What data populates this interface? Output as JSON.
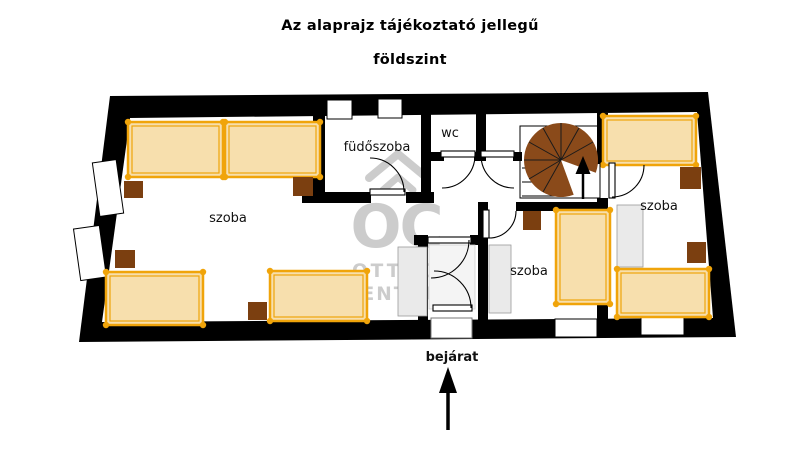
{
  "title": {
    "line1": "Az alaprajz tájékoztató jellegű",
    "line2": "földszint"
  },
  "rooms": {
    "large": {
      "label": "szoba"
    },
    "bathroom": {
      "label": "füdőszoba"
    },
    "wc": {
      "label": "wc"
    },
    "middle": {
      "label": "szoba"
    },
    "right": {
      "label": "szoba"
    }
  },
  "entrance": {
    "label": "bejárat"
  },
  "watermark": {
    "logo": "OC",
    "line1": "OTTHON",
    "line2": "CENTRUM"
  },
  "colors": {
    "wall": "#000000",
    "bed_fill": "#F7DFAD",
    "bed_frame": "#F0A40A",
    "nightstand": "#7B3F10",
    "staircase": "#8A4A1A",
    "wardrobe": "#EAEAEA",
    "watermark": "#C7C7C7"
  }
}
